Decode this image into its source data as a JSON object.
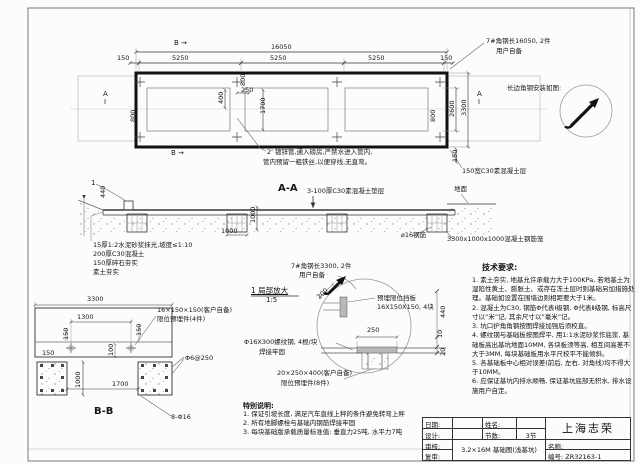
{
  "sheet": {
    "company": "上海志荣",
    "drawing_number": "编号: ZR32163-1",
    "drawing_title": "3.2×16M 基础图(浅基坑)"
  },
  "title_block": {
    "date_label": "日期:",
    "designer_label": "设计:",
    "checker_label": "审核:",
    "reviewer_label": "复审:",
    "name_label": "姓名:",
    "sections_label": "节数:",
    "sections_value": "3节",
    "title_label": "名称:",
    "company": "上海志荣",
    "drawing_title": "3.2×16M 基础图(浅基坑)",
    "number_value": "编号: ZR32163-1"
  },
  "tech_requirements": {
    "title": "技术要求:",
    "items": [
      "1. 素土夯实, 地基允许承载力大于100KPa, 若地基土为湿陷性黄土、膨胀土、或存在冻土层时则基础另加措施处理。基础如设置在围墙边则相距要大于1米。",
      "2. 混凝土为C30, 钢筋Φ代表Ⅰ级钢, Φ代表Ⅱ级钢, 标高尺寸以“米”记, 其余尺寸以“毫米”记。",
      "3. 坑口护角角钢按图焊接加强后须校直。",
      "4. 螺纹钢与基础板按图焊平, 用1:1水泥砂浆作底浆, 基础板高出基坑地面10MM, 各块板须等高, 相互间高差不大于3MM, 每块基础板用水平尺校平不能倾斜。",
      "5. 各基础板中心相对误差(前后, 左右, 对角线)均不得大于10MM。",
      "6. 应保证基坑内排水顺畅, 保证基坑底部无积水, 排水设施用户自定。"
    ]
  },
  "special_notes": {
    "title": "特别说明:",
    "items": [
      "1. 保证引坡长度, 满足汽车直线上秤的条件避免转弯上秤",
      "2. 所有地脚螺栓与基础内钢筋焊接牢固",
      "3. 每块基础版承载质量标准值: 垂直力25吨, 水平力7吨"
    ]
  },
  "annotations": {
    "plan": [
      {
        "t": "B →",
        "x": 174,
        "y": 40,
        "s": 7,
        "n": "section-marker-b-top"
      },
      {
        "t": "16050",
        "x": 271,
        "y": 44,
        "n": "dim-16050"
      },
      {
        "t": "150",
        "x": 117,
        "y": 55,
        "n": "dim-150"
      },
      {
        "t": "5250",
        "x": 172,
        "y": 55,
        "n": "dim-5250"
      },
      {
        "t": "5250",
        "x": 270,
        "y": 55,
        "n": "dim-5250"
      },
      {
        "t": "5250",
        "x": 368,
        "y": 55,
        "n": "dim-5250"
      },
      {
        "t": "150",
        "x": 440,
        "y": 55,
        "n": "dim-150"
      },
      {
        "t": "7#角钢长16050, 2件",
        "x": 486,
        "y": 38,
        "n": "note-angle-steel-16050"
      },
      {
        "t": "用户自备",
        "x": 496,
        "y": 48,
        "n": "note-user-supplied"
      },
      {
        "t": "800",
        "x": 240,
        "y": 86,
        "r": -90,
        "n": "dim-800"
      },
      {
        "t": "400",
        "x": 218,
        "y": 104,
        "r": -90,
        "n": "dim-400"
      },
      {
        "t": "250",
        "x": 241,
        "y": 87,
        "n": "dim-250"
      },
      {
        "t": "1700",
        "x": 260,
        "y": 114,
        "r": -90,
        "n": "dim-1700"
      },
      {
        "t": "800",
        "x": 130,
        "y": 122,
        "r": -90,
        "n": "dim-800"
      },
      {
        "t": "800",
        "x": 430,
        "y": 122,
        "r": -90,
        "n": "dim-800"
      },
      {
        "t": "2600",
        "x": 449,
        "y": 117,
        "r": -90,
        "n": "dim-2600"
      },
      {
        "t": "3300",
        "x": 461,
        "y": 116,
        "r": -90,
        "n": "dim-3300"
      },
      {
        "t": "150",
        "x": 452,
        "y": 162,
        "r": -90,
        "n": "dim-150"
      },
      {
        "t": "A",
        "x": 103,
        "y": 91,
        "s": 7,
        "n": "section-marker-a-left"
      },
      {
        "t": "A",
        "x": 477,
        "y": 91,
        "s": 7,
        "n": "section-marker-a-right"
      },
      {
        "t": "B →",
        "x": 171,
        "y": 150,
        "s": 7,
        "n": "section-marker-b-bottom"
      },
      {
        "t": "2' 镀锌管,通入磅房,严禁水进入管内,",
        "x": 267,
        "y": 149,
        "n": "note-pipe-line1"
      },
      {
        "t": "管内预留一粗铁丝,以便穿线,无直弯。",
        "x": 263,
        "y": 159,
        "n": "note-pipe-line2"
      },
      {
        "t": "长边角钢安装如图:",
        "x": 507,
        "y": 85,
        "n": "note-angle-install"
      },
      {
        "t": "150宽C30素混凝土层",
        "x": 462,
        "y": 168,
        "n": "note-concrete-strip"
      }
    ],
    "section_aa": [
      {
        "t": "A-A",
        "x": 278,
        "y": 183,
        "s": 10,
        "b": 1,
        "n": "section-aa-title"
      },
      {
        "t": "3-100厚C30素混凝土垫层",
        "x": 307,
        "y": 188,
        "n": "note-cushion"
      },
      {
        "t": "地面",
        "x": 454,
        "y": 186,
        "n": "note-ground"
      },
      {
        "t": "1",
        "x": 91,
        "y": 180,
        "s": 7,
        "n": "detail-mark-1"
      },
      {
        "t": "440",
        "x": 100,
        "y": 198,
        "r": -90,
        "n": "dim-440"
      },
      {
        "t": "1000",
        "x": 221,
        "y": 228,
        "n": "dim-1000"
      },
      {
        "t": "1000",
        "x": 250,
        "y": 223,
        "r": -90,
        "n": "dim-1000"
      },
      {
        "t": "⌀16钢筋",
        "x": 401,
        "y": 232,
        "n": "note-rebar-16"
      },
      {
        "t": "3300x1000x1000混凝土钢筋笼",
        "x": 447,
        "y": 236,
        "n": "note-rebar-cage"
      },
      {
        "t": "15厚1:2水泥砂浆抹光,坡度≤1:10",
        "x": 93,
        "y": 242,
        "n": "note-layer-mortar"
      },
      {
        "t": "200厚C30混凝土",
        "x": 93,
        "y": 251,
        "n": "note-layer-concrete"
      },
      {
        "t": "150厚碎石夯实",
        "x": 93,
        "y": 260,
        "n": "note-layer-gravel"
      },
      {
        "t": "素土夯实",
        "x": 93,
        "y": 269,
        "n": "note-layer-soil"
      }
    ],
    "detail": [
      {
        "t": "7#角钢长3300, 2件",
        "x": 291,
        "y": 263,
        "n": "note-angle-steel-3300"
      },
      {
        "t": "用户自备",
        "x": 299,
        "y": 272,
        "n": "note-user-supplied-2"
      },
      {
        "t": "1 局部放大",
        "x": 251,
        "y": 287,
        "s": 7.5,
        "u": 1,
        "n": "detail-title"
      },
      {
        "t": "1:5",
        "x": 266,
        "y": 297,
        "s": 7,
        "n": "detail-scale"
      },
      {
        "t": "200",
        "x": 316,
        "y": 296,
        "r": -45,
        "n": "dim-200"
      },
      {
        "t": "预埋限位挡板",
        "x": 377,
        "y": 295,
        "n": "note-limit-plate-1"
      },
      {
        "t": "16X150X150, 4块",
        "x": 377,
        "y": 304,
        "n": "note-limit-plate-2"
      },
      {
        "t": "250",
        "x": 367,
        "y": 327,
        "n": "dim-250"
      },
      {
        "t": "440",
        "x": 440,
        "y": 318,
        "r": -90,
        "n": "dim-440"
      },
      {
        "t": "10",
        "x": 437,
        "y": 338,
        "r": -90,
        "n": "dim-10"
      },
      {
        "t": "20",
        "x": 440,
        "y": 356,
        "r": -90,
        "n": "dim-20"
      },
      {
        "t": "Φ16X300螺纹钢, 4根/块",
        "x": 244,
        "y": 339,
        "n": "note-threaded-bar-1"
      },
      {
        "t": "焊接牢固",
        "x": 259,
        "y": 349,
        "n": "note-threaded-bar-2"
      },
      {
        "t": "20×250×400(客户自备)",
        "x": 277,
        "y": 370,
        "n": "note-embed-plate-1"
      },
      {
        "t": "限位预埋件(8件)",
        "x": 281,
        "y": 380,
        "n": "note-embed-plate-2"
      }
    ],
    "section_bb": [
      {
        "t": "3300",
        "x": 87,
        "y": 296,
        "n": "dim-3300"
      },
      {
        "t": "1300",
        "x": 77,
        "y": 314,
        "n": "dim-1300"
      },
      {
        "t": "16×150×150(客户自备)",
        "x": 157,
        "y": 307,
        "n": "note-limit-embed-1"
      },
      {
        "t": "限位预埋件(4件)",
        "x": 157,
        "y": 316,
        "n": "note-limit-embed-2"
      },
      {
        "t": "150",
        "x": 63,
        "y": 340,
        "r": -90,
        "n": "dim-150"
      },
      {
        "t": "150",
        "x": 136,
        "y": 336,
        "r": -90,
        "n": "dim-150"
      },
      {
        "t": "150",
        "x": 42,
        "y": 350,
        "n": "dim-150"
      },
      {
        "t": "100",
        "x": 108,
        "y": 356,
        "r": -90,
        "n": "dim-100"
      },
      {
        "t": "Φ6@250",
        "x": 185,
        "y": 355,
        "n": "note-stirrup"
      },
      {
        "t": "1000",
        "x": 75,
        "y": 388,
        "r": -90,
        "n": "dim-1000"
      },
      {
        "t": "1700",
        "x": 112,
        "y": 381,
        "n": "dim-1700"
      },
      {
        "t": "8-Φ16",
        "x": 171,
        "y": 414,
        "n": "note-main-bars"
      },
      {
        "t": "B-B",
        "x": 94,
        "y": 406,
        "s": 10,
        "b": 1,
        "n": "section-bb-title"
      }
    ]
  }
}
